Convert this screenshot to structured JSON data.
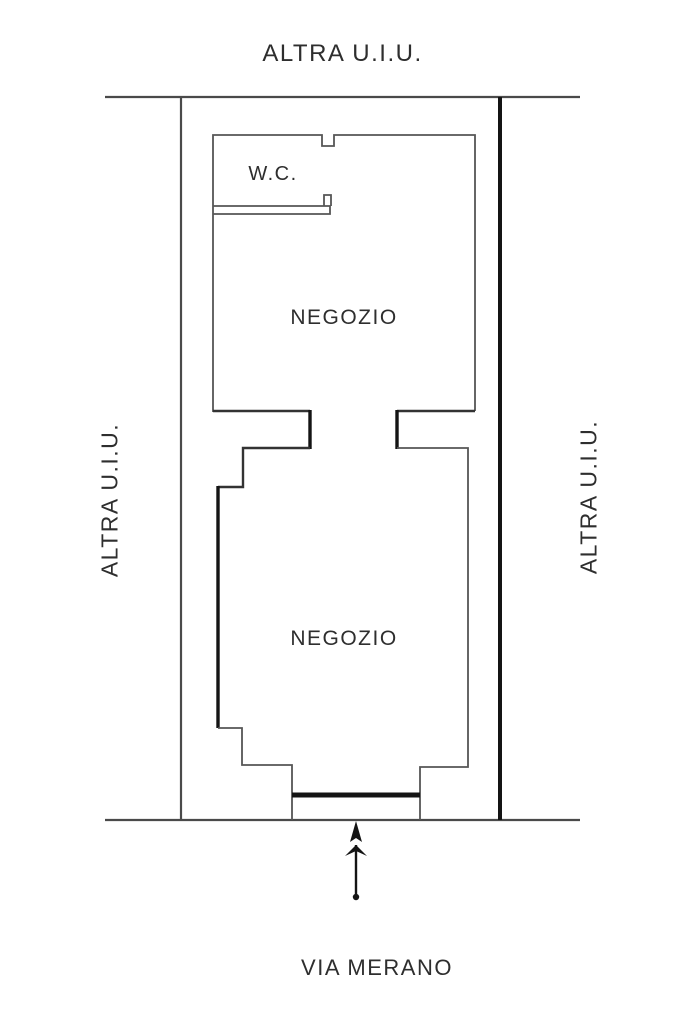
{
  "plan": {
    "adjacent_top_label": "ALTRA U.I.U.",
    "adjacent_left_label": "ALTRA U.I.U.",
    "adjacent_right_label": "ALTRA U.I.U.",
    "rooms": [
      {
        "name": "W.C."
      },
      {
        "name": "NEGOZIO"
      },
      {
        "name": "NEGOZIO"
      }
    ],
    "street_label": "VIA MERANO"
  },
  "icons": {
    "entrance_arrow": "up-arrow"
  },
  "colors": {
    "background": "#ffffff",
    "boundary": "#4a4a4a",
    "wall": "#565656",
    "bold": "#141414",
    "text": "#2e2e2e"
  }
}
